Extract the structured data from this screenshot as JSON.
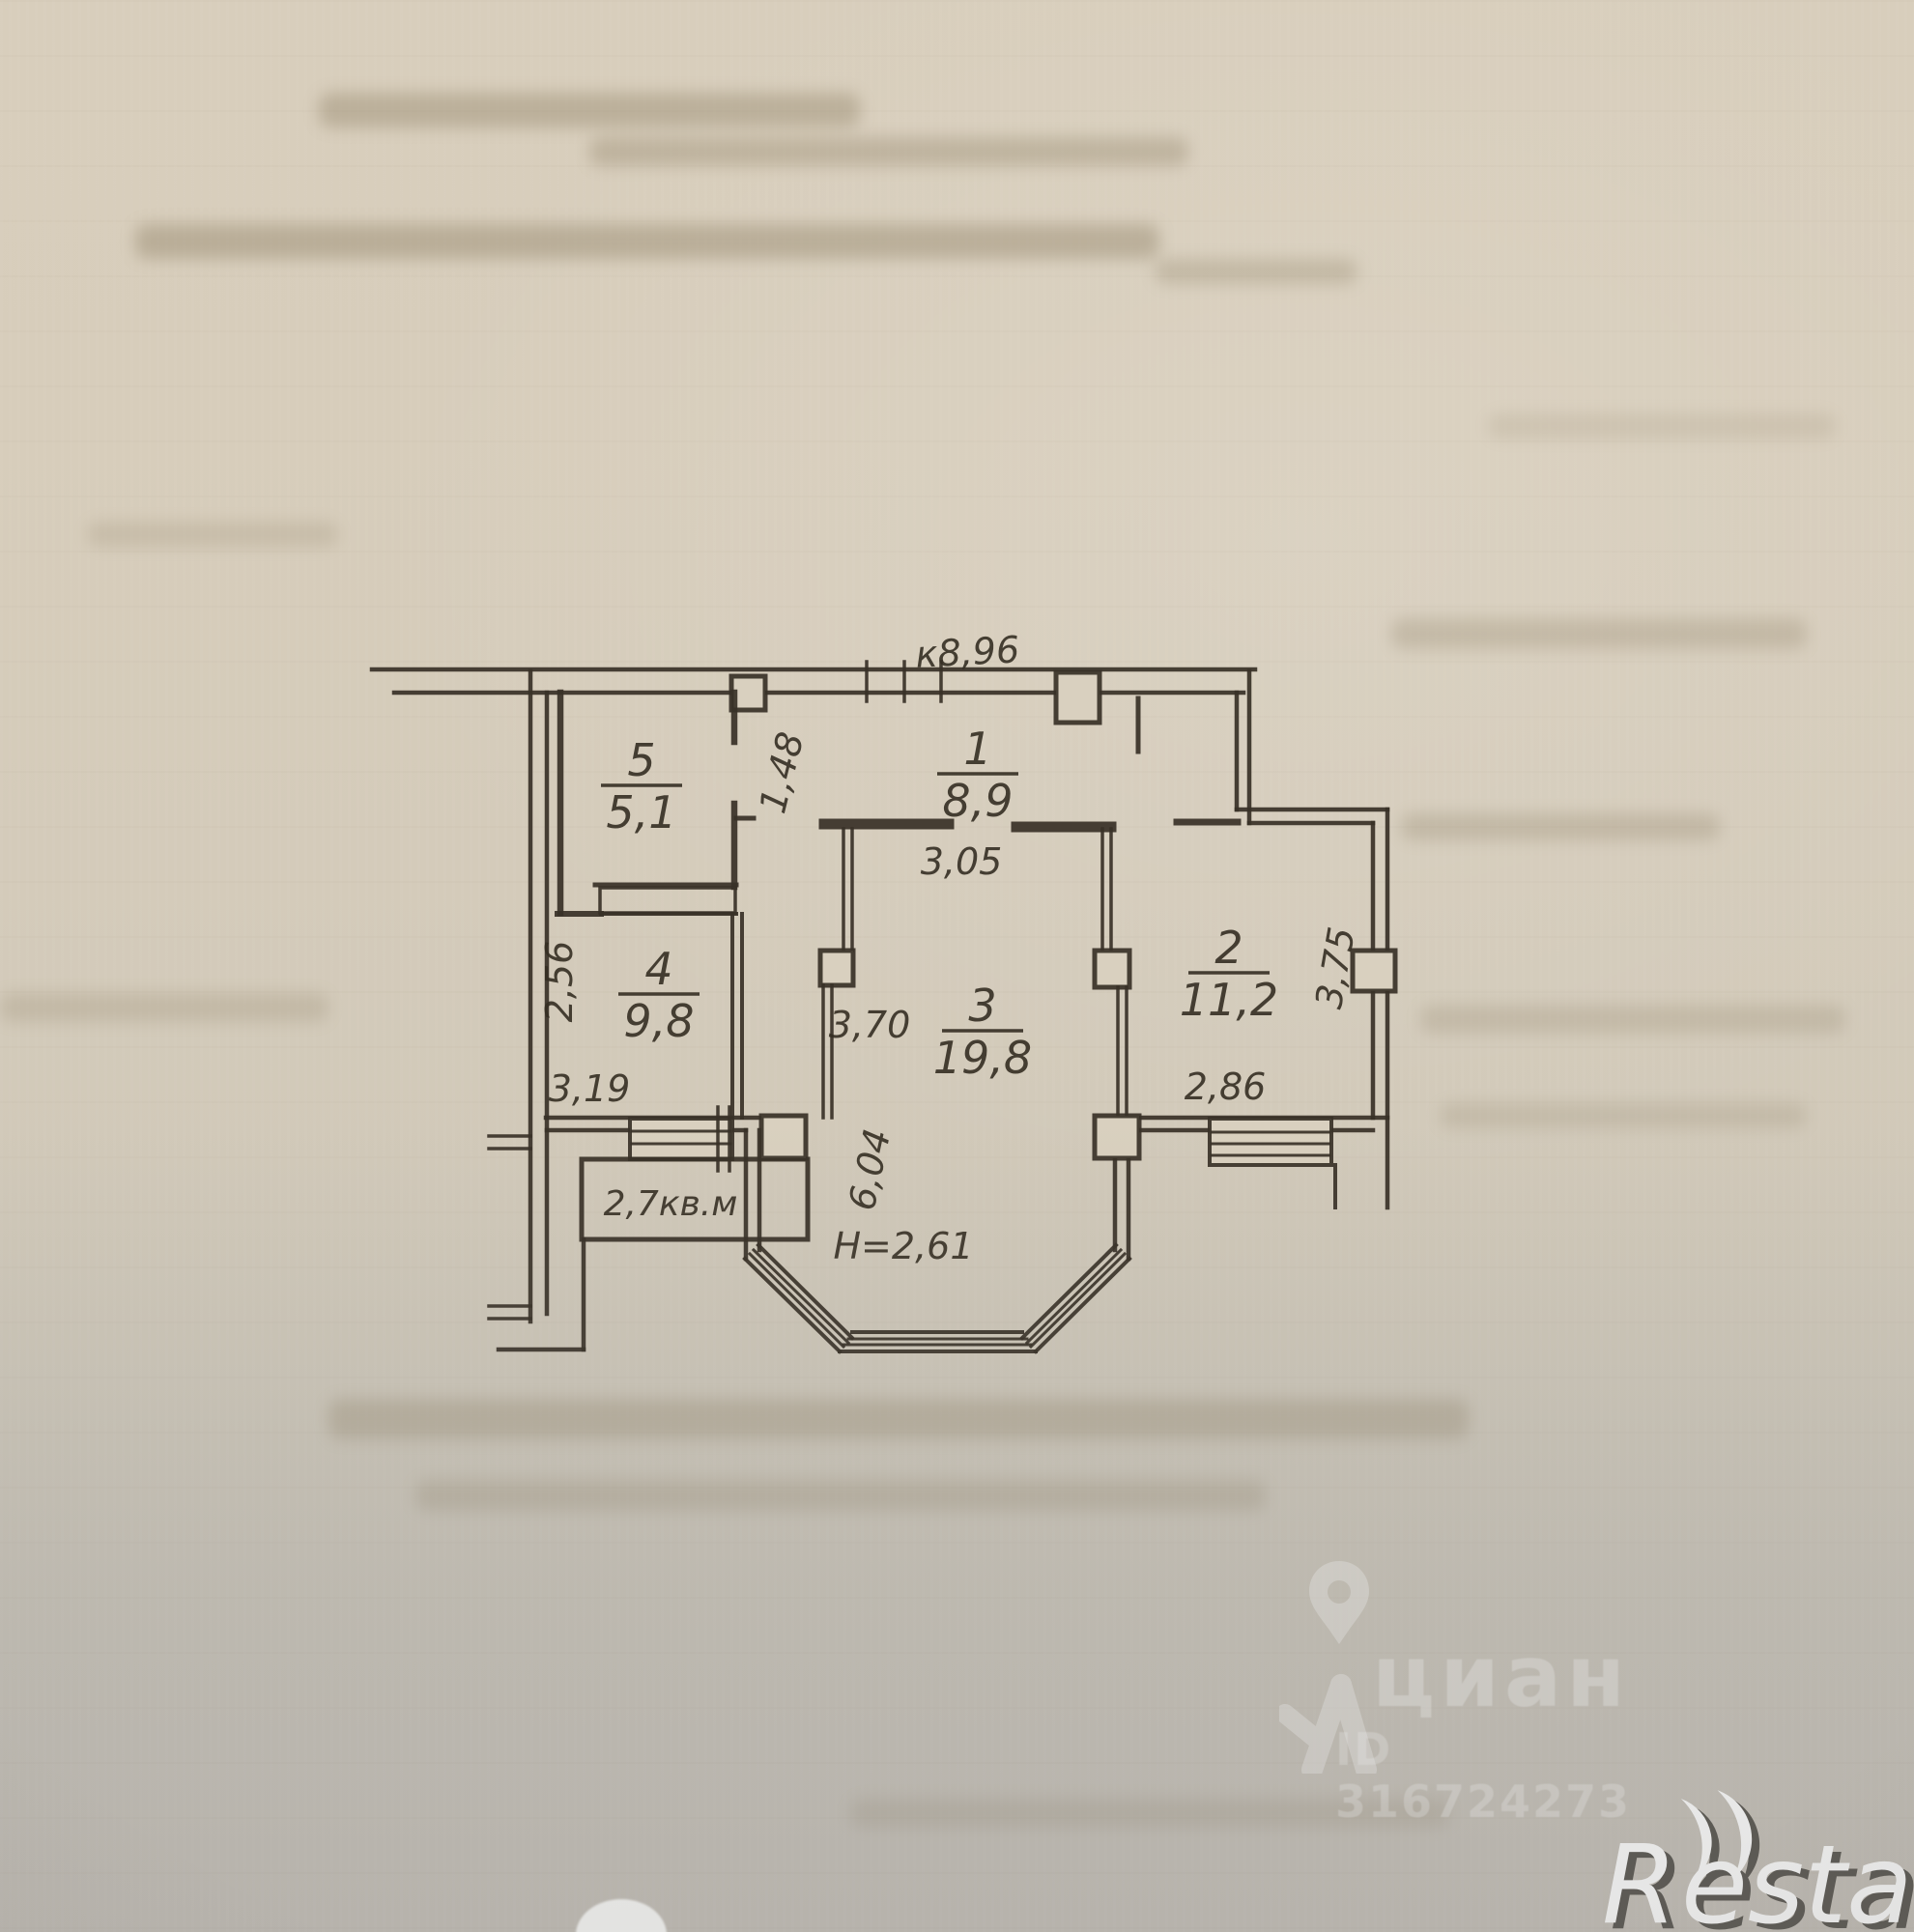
{
  "plan": {
    "top_dim_label": "к8,96",
    "rooms": [
      {
        "num": "1",
        "area": "8,9"
      },
      {
        "num": "2",
        "area": "11,2"
      },
      {
        "num": "3",
        "area": "19,8"
      },
      {
        "num": "4",
        "area": "9,8"
      },
      {
        "num": "5",
        "area": "5,1"
      }
    ],
    "dims": {
      "hall_width": "3,05",
      "passage_width": "1,48",
      "room4_left": "2,56",
      "room4_bottom": "3,19",
      "room3_left": "3,70",
      "room2_bottom": "2,86",
      "room2_right": "3,75",
      "bay_depth": "6,04",
      "ceiling_height": "Н=2,61",
      "balcony_area": "2,7кв.м"
    }
  },
  "watermark_cian": {
    "brand": "циан",
    "listing_id": "ID 316724273"
  },
  "watermark_restate": {
    "brand_r": "R",
    "brand_suffix": "estate"
  }
}
